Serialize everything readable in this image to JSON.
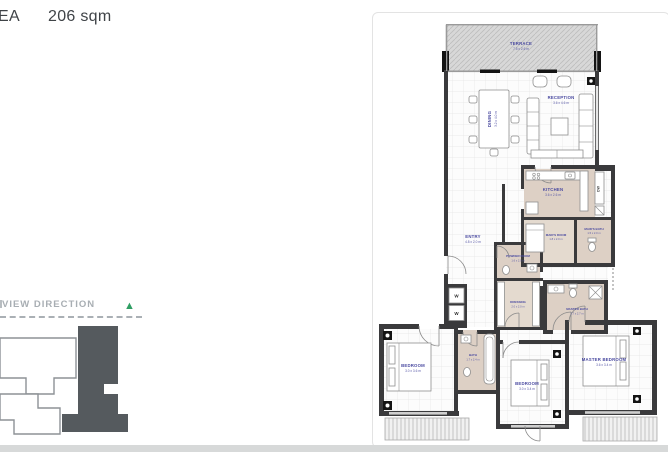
{
  "header": {
    "area_label": "EA",
    "area_value": "206 sqm"
  },
  "key_plan": {
    "title": "VIEW DIRECTION",
    "arrow": "▲",
    "arrow_color": "#2f9e63"
  },
  "plan": {
    "rooms": {
      "terrace": {
        "name": "TERRACE",
        "dims": "7.5 x 2.6 m"
      },
      "dining": {
        "name": "DINING",
        "dims": "3.2 x 4.0 m"
      },
      "reception": {
        "name": "RECEPTION",
        "dims": "3.6 x 4.6 m"
      },
      "kitchen": {
        "name": "KITCHEN",
        "dims": "3.6 x 2.6 m"
      },
      "maids_room": {
        "name": "MAID'S ROOM",
        "dims": "1.8 x 2.0 m"
      },
      "maids_bath": {
        "name": "MAID'S BATH",
        "dims": "1.5 x 2.0 m"
      },
      "entry": {
        "name": "ENTRY",
        "dims": "4.8 x 2.0 m"
      },
      "powder_room": {
        "name": "POWDER ROOM",
        "dims": "1.6 x 2.0 m"
      },
      "dressing": {
        "name": "DRESSING",
        "dims": "2.0 x 2.0 m"
      },
      "master_bath": {
        "name": "MASTER BATH",
        "dims": "1.7 x 2.7 m"
      },
      "bath": {
        "name": "BATH",
        "dims": "1.7 x 2.4 m"
      },
      "bedroom_1": {
        "name": "BEDROOM",
        "dims": "3.0 x 3.6 m"
      },
      "bedroom_2": {
        "name": "BEDROOM",
        "dims": "3.0 x 3.4 m"
      },
      "master_bedroom": {
        "name": "MASTER BEDROOM",
        "dims": "3.6 x 3.4 m"
      }
    },
    "appliances": {
      "dishwasher": "DW",
      "wardrobe": "W"
    }
  },
  "colors": {
    "label": "#4a4aa0",
    "wall": "#3a3a3c",
    "beige": "#ddd0c5",
    "accent_green": "#2f9e63"
  }
}
